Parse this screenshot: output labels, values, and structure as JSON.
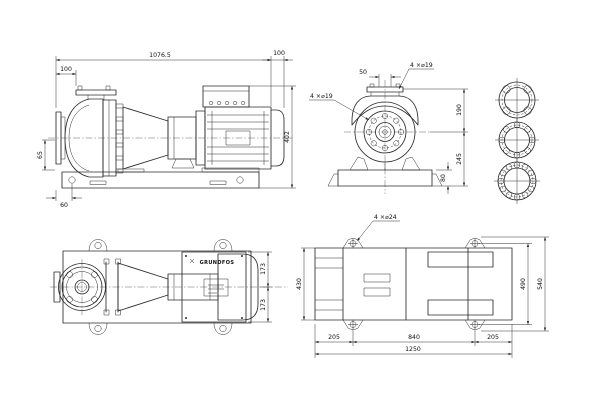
{
  "side_view": {
    "overall_length": "1076.5",
    "motor_end": "100",
    "suction_offset": "100",
    "suction_height": "65",
    "hole_offset": "60",
    "overall_height": "402"
  },
  "end_view": {
    "port_width": "50",
    "discharge_holes": "4 ×⌀19",
    "suction_holes": "4 ×⌀19",
    "center_to_top": "190",
    "center_to_base": "245",
    "base_height": "80"
  },
  "top_view": {
    "half_width_front": "173",
    "half_width_rear": "173",
    "logo": "GRUNDFOS"
  },
  "base_view": {
    "lug_holes": "4 ×⌀24",
    "left_width": "430",
    "hole_span_width": "490",
    "overall_width": "540",
    "left_margin": "205",
    "hole_span_length": "840",
    "right_margin": "205",
    "overall_length": "1250"
  }
}
